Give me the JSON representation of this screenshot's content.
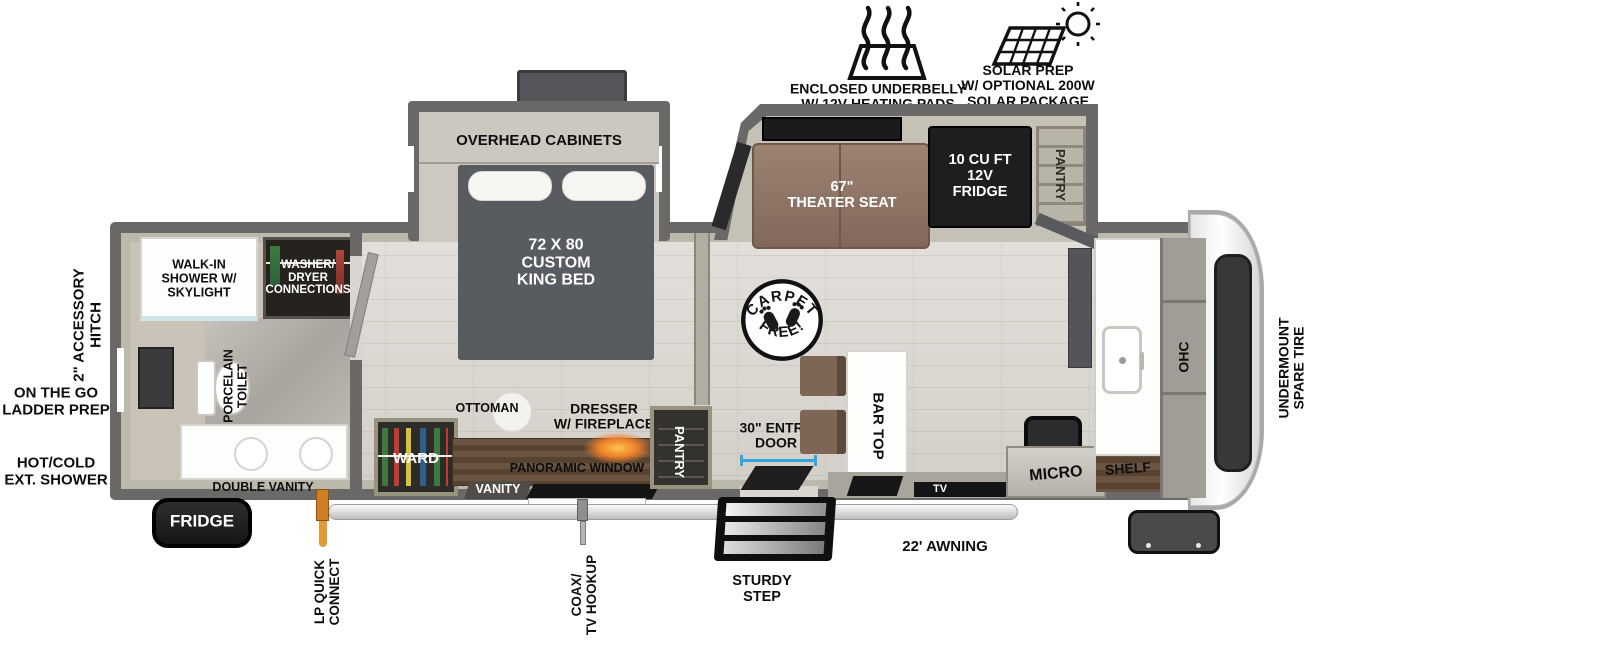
{
  "badges": {
    "underbelly": "ENCLOSED UNDERBELLY\nW/ 12V HEATING PADS",
    "solar": "SOLAR PREP\nW/ OPTIONAL 200W\nSOLAR PACKAGE"
  },
  "exterior": {
    "hitch": "2\" ACCESSORY\nHITCH",
    "ladder_prep": "ON THE GO\nLADDER PREP",
    "ext_shower": "HOT/COLD\nEXT. SHOWER",
    "fridge_compartment": "FRIDGE",
    "lp_quick_connect": "LP QUICK\nCONNECT",
    "coax_tv_hookup": "COAX/\nTV HOOKUP",
    "sturdy_step": "STURDY\nSTEP",
    "awning": "22' AWNING",
    "spare_tire": "UNDERMOUNT\nSPARE TIRE"
  },
  "bathroom": {
    "walk_in_shower": "WALK-IN\nSHOWER W/\nSKYLIGHT",
    "washer_dryer": "WASHER/\nDRYER\nCONNECTIONS",
    "toilet": "PORCELAIN\nTOILET",
    "double_vanity": "DOUBLE VANITY"
  },
  "bedroom": {
    "overhead_cabinets": "OVERHEAD CABINETS",
    "king_bed": "72 X  80\nCUSTOM\nKING BED",
    "ward": "WARD",
    "ottoman": "OTTOMAN",
    "dresser_fireplace": "DRESSER\nW/ FIREPLACE",
    "panoramic_window": "PANORAMIC WINDOW",
    "vanity": "VANITY",
    "pantry": "PANTRY"
  },
  "living": {
    "carpet_free_top": "CARPET",
    "carpet_free_bottom": "FREE!",
    "entry_door": "30\" ENTRY\nDOOR",
    "theater_seat": "67\"\nTHEATER SEAT",
    "fridge_12v": "10 CU FT\n12V\nFRIDGE",
    "pantry": "PANTRY",
    "bar_top": "BAR TOP",
    "tv": "TV",
    "micro": "MICRO",
    "shelf": "SHELF",
    "ohc": "OHC"
  },
  "colors": {
    "wall": "#6b6968",
    "accent_blue": "#2fa8e0",
    "lp_orange": "#d98a2b",
    "seat_brown": "#8a7164",
    "wood_brown": "#5e4a39"
  }
}
